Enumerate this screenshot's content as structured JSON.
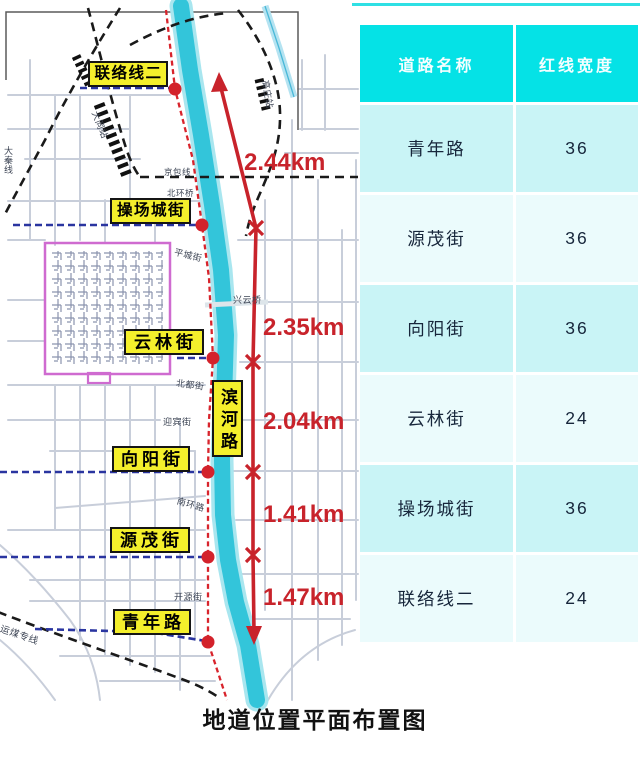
{
  "caption": "地道位置平面布置图",
  "table": {
    "header": {
      "road_name": "道路名称",
      "red_line_width": "红线宽度"
    },
    "rows": [
      {
        "name": "青年路",
        "width": "36"
      },
      {
        "name": "源茂街",
        "width": "36"
      },
      {
        "name": "向阳街",
        "width": "36"
      },
      {
        "name": "云林街",
        "width": "24"
      },
      {
        "name": "操场城街",
        "width": "36"
      },
      {
        "name": "联络线二",
        "width": "24"
      }
    ]
  },
  "map": {
    "street_labels": {
      "lianluo2": "联络线二",
      "caochangcheng": "操场城街",
      "yunlin": "云林街",
      "binhe": "滨河路",
      "xiangyang": "向阳街",
      "yuanmao": "源茂街",
      "qingnian": "青年路"
    },
    "distances": {
      "d1": "2.44km",
      "d2": "2.35km",
      "d3": "2.04km",
      "d4": "1.41km",
      "d5": "1.47km"
    },
    "minor_labels": {
      "datong_station": "大同站",
      "gaozhuang_station": "高庄站",
      "daqin_line": "大秦线",
      "jingbao_line": "京包线",
      "beihuan_bridge": "北环桥",
      "pingcheng_street": "平城街",
      "xingyun_bridge": "兴云桥",
      "beidu_street": "北都街",
      "yingbin_street": "迎宾街",
      "nanhuan_road": "南环路",
      "kaiyuan_street": "开源街",
      "coal_line": "运煤专线"
    }
  },
  "colors": {
    "river": "#33C5DA",
    "highlight_red": "#C8232B",
    "label_yellow": "#F4EF2C",
    "table_header": "#05E2E6",
    "table_row_dark": "#C9F4F6",
    "table_row_light": "#EBFBFC",
    "boundary_purple": "#CF6BD0",
    "street_dash_blue": "#2A35A0"
  }
}
